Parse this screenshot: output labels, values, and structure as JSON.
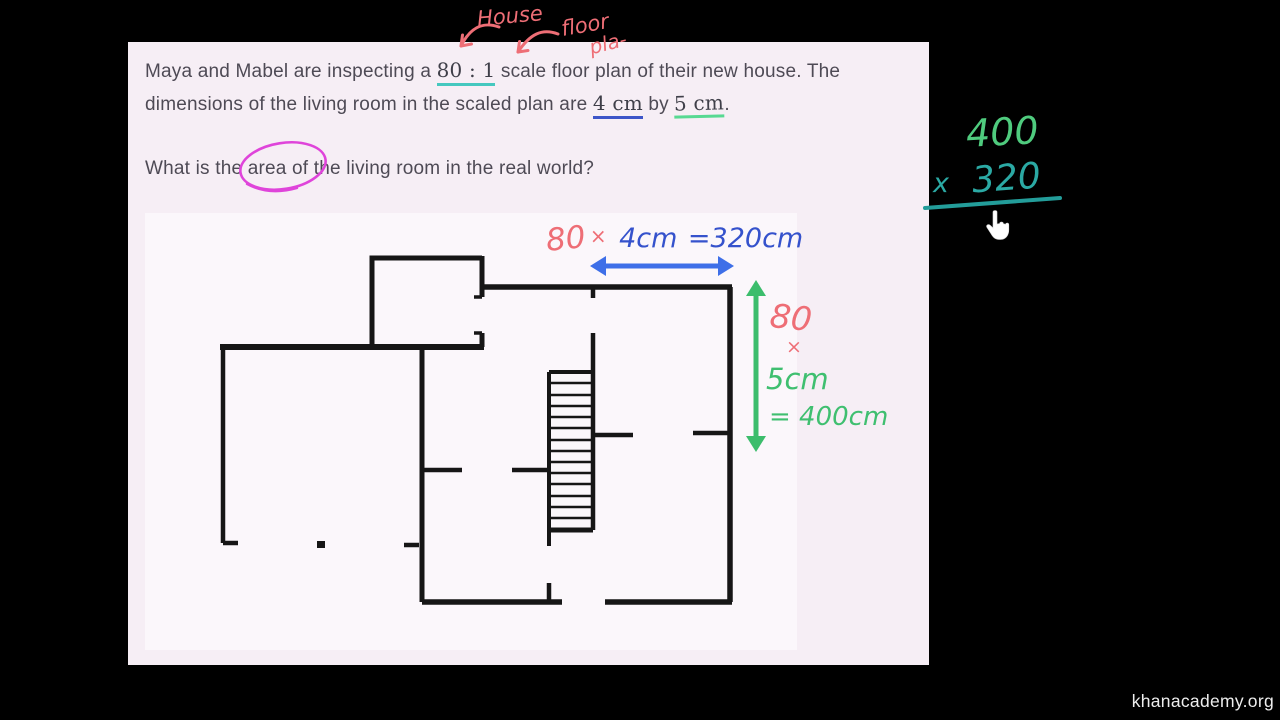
{
  "page": {
    "watermark": "khanacademy.org"
  },
  "problem": {
    "line1_pre": "Maya and Mabel are inspecting a ",
    "scale_ratio": "80 : 1",
    "line1_post": " scale floor plan of their new house. The",
    "line2_pre": "dimensions of the living room in the scaled plan are ",
    "dim_width": "4 cm",
    "line2_mid": " by ",
    "dim_height": "5 cm",
    "line2_end": ".",
    "question_pre": "What is the ",
    "question_circled_word": "area",
    "question_post": " of the living room in the real world?"
  },
  "scribbles": {
    "house_label": "House",
    "floor_label": "floor",
    "plan_label": "pla-",
    "width_calc": {
      "factor": "80",
      "times": "×",
      "value": "4cm",
      "result": "=320cm"
    },
    "height_calc": {
      "factor": "80",
      "times": "×",
      "value": "5cm",
      "result": "= 400cm"
    },
    "board_multiplication": {
      "operand_top": "400",
      "times_sign": "x",
      "operand_bottom": "320"
    }
  },
  "colors": {
    "background": "#000000",
    "frame_background": "#f6eef5",
    "plan_background": "#fbf7fb",
    "body_text": "#4e4a55",
    "wall": "#161616",
    "salmon_ink": "#ee6e76",
    "blue_ink": "#3552cc",
    "blue_arrow": "#3e6fe8",
    "green_ink": "#3fbf70",
    "board_green": "#4fcb7e",
    "teal_ink": "#2ba9a4",
    "teal_underline": "#45c8bf",
    "blue_underline": "#3d55c8",
    "green_underline": "#57d992",
    "magenta_circle": "#df44da"
  }
}
